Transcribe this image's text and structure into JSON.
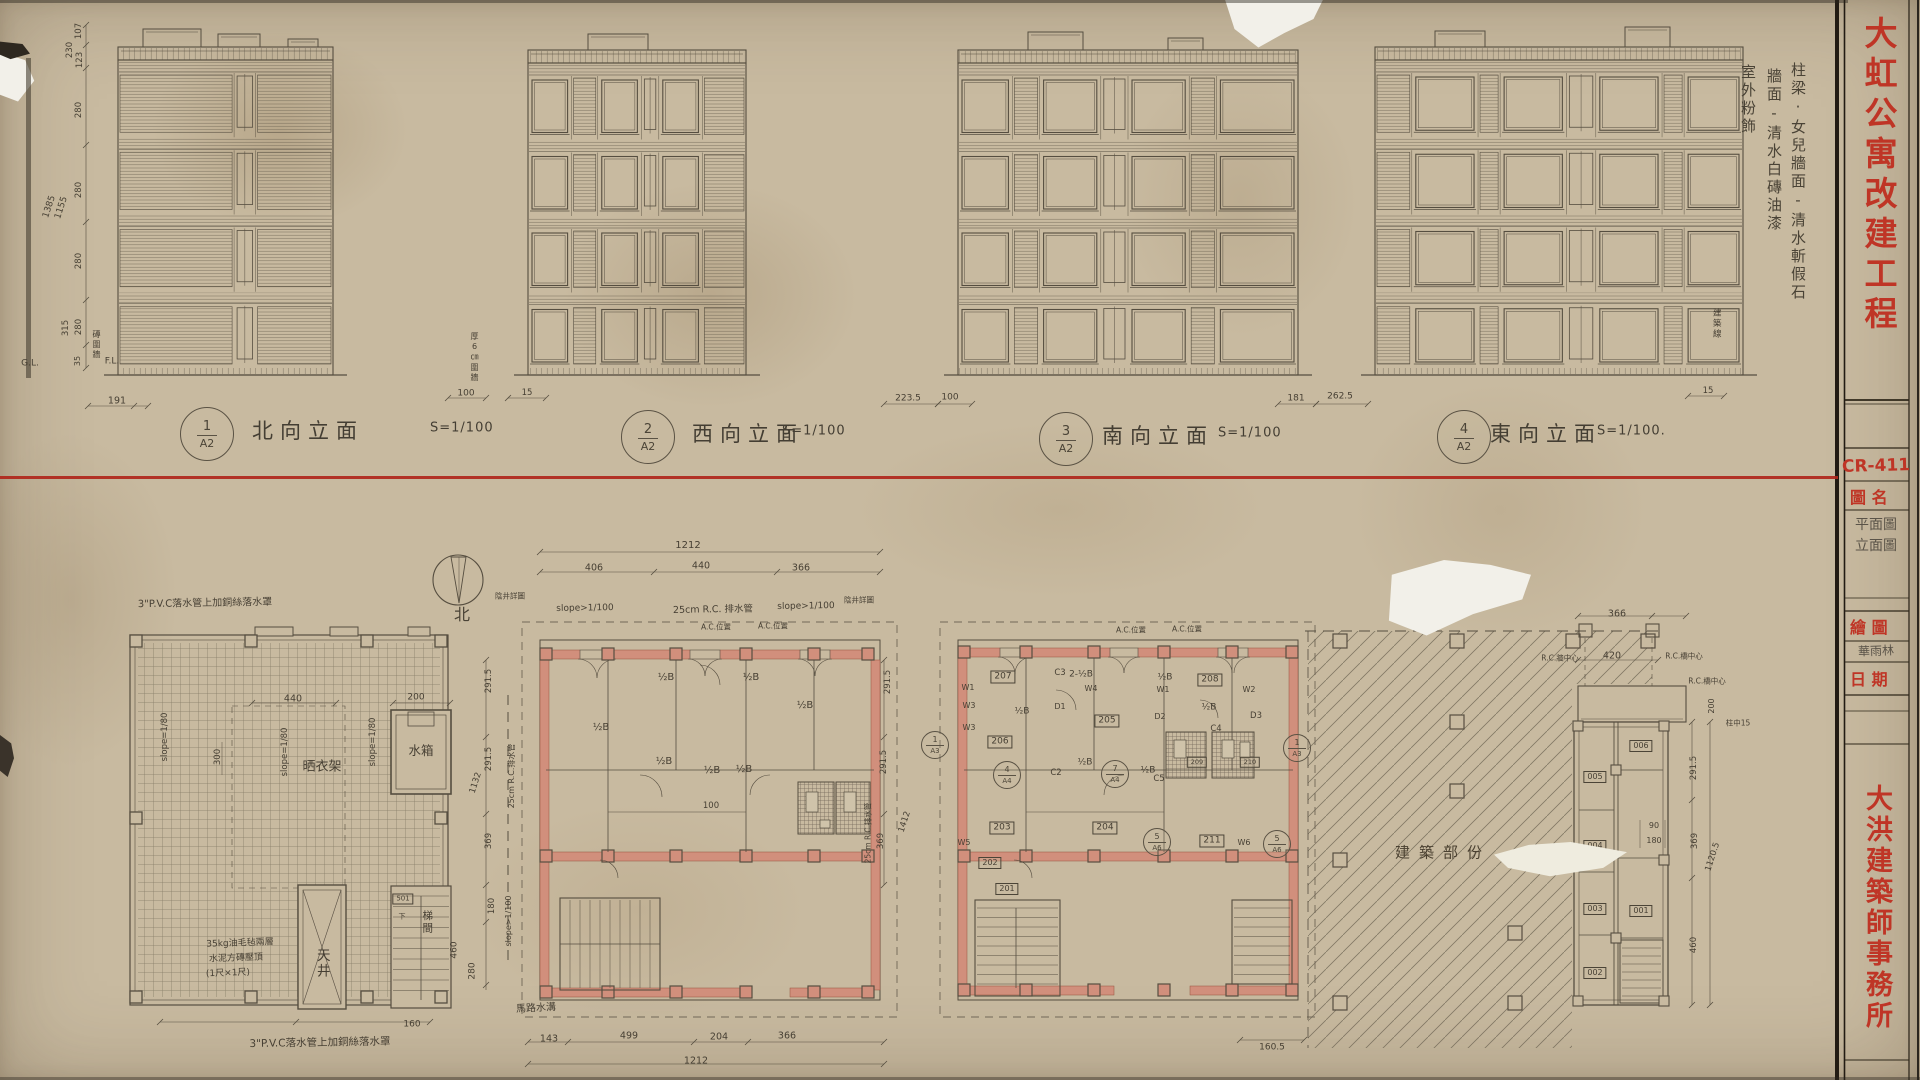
{
  "sheet": {
    "project_title": "大虹公寓改建工程",
    "drawing_code": "CR-411",
    "field_drawing_name": "圖 名",
    "drawing_names": [
      "平面圖",
      "立面圖"
    ],
    "field_draftsman": "繪 圖",
    "draftsman": "華雨林",
    "field_date": "日 期",
    "firm_name": "大洪建築師事務所"
  },
  "finish_notes": [
    "柱梁·女兒牆面-清水斬假石",
    "牆面-清水白磚油漆",
    "室外粉飾"
  ],
  "compass_label": "北",
  "elevations": [
    {
      "num": "1",
      "sheet": "A2",
      "name": "北向立面",
      "scale": "S=1/100"
    },
    {
      "num": "2",
      "sheet": "A2",
      "name": "西向立面",
      "scale": "S=1/100"
    },
    {
      "num": "3",
      "sheet": "A2",
      "name": "南向立面",
      "scale": "S=1/100"
    },
    {
      "num": "4",
      "sheet": "A2",
      "name": "東向立面",
      "scale": "S=1/100."
    }
  ],
  "ref_badges": [
    {
      "n": "1",
      "s": "A3",
      "x": 935,
      "y": 745
    },
    {
      "n": "1",
      "s": "A3",
      "x": 1297,
      "y": 748
    },
    {
      "n": "4",
      "s": "A4",
      "x": 1007,
      "y": 775
    },
    {
      "n": "7",
      "s": "A4",
      "x": 1115,
      "y": 774
    },
    {
      "n": "5",
      "s": "A6",
      "x": 1157,
      "y": 842
    },
    {
      "n": "5",
      "s": "A6",
      "x": 1277,
      "y": 844
    }
  ],
  "annotations": [
    [
      "107",
      79,
      31,
      -90,
      8.5
    ],
    [
      "230",
      70,
      50,
      -90,
      8.5
    ],
    [
      "123",
      80,
      60,
      -90,
      8.5
    ],
    [
      "280",
      79,
      110,
      -90,
      8.5
    ],
    [
      "280",
      79,
      190,
      -90,
      8.5
    ],
    [
      "1385",
      50,
      207,
      -72,
      9
    ],
    [
      "1155",
      62,
      208,
      -72,
      9
    ],
    [
      "280",
      79,
      261,
      -90,
      8.5
    ],
    [
      "315",
      66,
      328,
      -90,
      8.5
    ],
    [
      "280",
      79,
      327,
      -90,
      8.5
    ],
    [
      "35",
      78,
      361,
      -90,
      8
    ],
    [
      "G.L.",
      30,
      364,
      0,
      9
    ],
    [
      "F.L.",
      112,
      362,
      0,
      9
    ],
    [
      "191",
      117,
      401,
      0,
      9.5
    ],
    [
      "100",
      466,
      394,
      0,
      9
    ],
    [
      "15",
      527,
      393,
      0,
      8.5
    ],
    [
      "223.5",
      908,
      399,
      0,
      9
    ],
    [
      "100",
      950,
      398,
      0,
      9
    ],
    [
      "181",
      1296,
      399,
      0,
      9
    ],
    [
      "262.5",
      1340,
      397,
      0,
      9
    ],
    [
      "15",
      1708,
      391,
      0,
      8.5
    ],
    [
      "磚圍牆",
      96,
      330,
      0,
      8,
      "v"
    ],
    [
      "厚6㎝圍牆",
      474,
      332,
      0,
      8,
      "v"
    ],
    [
      "建築線",
      1716,
      308,
      0,
      8.5,
      "v"
    ],
    [
      "3\"P.V.C落水管上加銅絲落水罩",
      205,
      604,
      -1,
      10
    ],
    [
      "slope=1/80",
      165,
      737,
      -90,
      8.5
    ],
    [
      "slope=1/80",
      285,
      752,
      -90,
      8.5
    ],
    [
      "slope=1/80",
      373,
      742,
      -90,
      8.5
    ],
    [
      "440",
      293,
      699,
      0,
      9.5
    ],
    [
      "200",
      416,
      698,
      0,
      9
    ],
    [
      "300",
      218,
      757,
      -90,
      8.5
    ],
    [
      "晒衣架",
      322,
      767,
      0,
      13
    ],
    [
      "水箱",
      421,
      751,
      0,
      12.5
    ],
    [
      "35kg油毛毡兩層",
      240,
      944,
      -2,
      9
    ],
    [
      "水泥方磚壓頂",
      236,
      959,
      -2,
      9
    ],
    [
      "(1尺×1尺)",
      228,
      974,
      -2,
      9
    ],
    [
      "天井",
      321,
      948,
      0,
      13.5,
      "v"
    ],
    [
      "梯間",
      427,
      910,
      0,
      10.5,
      "v"
    ],
    [
      "501",
      403,
      899,
      0,
      7,
      "b"
    ],
    [
      "下",
      402,
      917,
      0,
      7
    ],
    [
      "460",
      455,
      950,
      -90,
      9
    ],
    [
      "280",
      473,
      971,
      -90,
      9
    ],
    [
      "160",
      412,
      1025,
      0,
      9
    ],
    [
      "3\"P.V.C落水管上加銅絲落水罩",
      320,
      1043,
      -1,
      10.5
    ],
    [
      "291.5",
      489,
      681,
      -90,
      8.5
    ],
    [
      "291.5",
      489,
      759,
      -90,
      8.5
    ],
    [
      "1132",
      476,
      783,
      -72,
      8.5
    ],
    [
      "369",
      489,
      841,
      -90,
      8.5
    ],
    [
      "180",
      492,
      906,
      -90,
      8.5
    ],
    [
      "25cm R.C.排水管",
      512,
      776,
      -90,
      8
    ],
    [
      "slope>1/100",
      509,
      921,
      -90,
      8
    ],
    [
      "1212",
      688,
      546,
      0,
      10
    ],
    [
      "406",
      594,
      568,
      0,
      9.5
    ],
    [
      "440",
      701,
      566,
      0,
      9.5
    ],
    [
      "366",
      801,
      568,
      0,
      9.5
    ],
    [
      "slope>1/100",
      585,
      609,
      -1,
      9
    ],
    [
      "25cm R.C. 排水管",
      713,
      610,
      -1,
      9.5
    ],
    [
      "slope>1/100",
      806,
      607,
      -1,
      9
    ],
    [
      "陰井詳圖",
      510,
      596,
      0,
      7.5
    ],
    [
      "陰井詳圖",
      859,
      600,
      0,
      7.5
    ],
    [
      "A.C.位置",
      716,
      627,
      0,
      7.5
    ],
    [
      "A.C.位置",
      773,
      626,
      0,
      7.5
    ],
    [
      "½B",
      666,
      678,
      0,
      10
    ],
    [
      "½B",
      751,
      678,
      0,
      10
    ],
    [
      "½B",
      601,
      728,
      0,
      10
    ],
    [
      "½B",
      664,
      762,
      0,
      10
    ],
    [
      "½B",
      805,
      706,
      0,
      10
    ],
    [
      "½B",
      712,
      771,
      0,
      10
    ],
    [
      "½B",
      744,
      770,
      0,
      10
    ],
    [
      "100",
      711,
      806,
      0,
      8.5
    ],
    [
      "143",
      549,
      1039,
      0,
      9.5
    ],
    [
      "499",
      629,
      1036,
      0,
      9.5
    ],
    [
      "204",
      719,
      1037,
      0,
      9.5
    ],
    [
      "366",
      787,
      1036,
      0,
      9.5
    ],
    [
      "1212",
      696,
      1061,
      0,
      9.5
    ],
    [
      "馬路水溝",
      536,
      1009,
      -3,
      10
    ],
    [
      "291.5",
      888,
      682,
      -90,
      8.5
    ],
    [
      "291.5",
      884,
      762,
      -90,
      8.5
    ],
    [
      "369",
      881,
      841,
      -90,
      8.5
    ],
    [
      "1412",
      905,
      822,
      -72,
      8.5
    ],
    [
      "25cm R.C.排水管",
      868,
      833,
      -90,
      7.5
    ],
    [
      "207",
      1003,
      677,
      0,
      9,
      "b"
    ],
    [
      "208",
      1210,
      680,
      0,
      9,
      "b"
    ],
    [
      "206",
      1000,
      742,
      0,
      9,
      "b"
    ],
    [
      "205",
      1107,
      721,
      0,
      9,
      "b"
    ],
    [
      "203",
      1002,
      828,
      0,
      9,
      "b"
    ],
    [
      "204",
      1105,
      828,
      0,
      9,
      "b"
    ],
    [
      "211",
      1212,
      841,
      0,
      9,
      "b"
    ],
    [
      "209",
      1197,
      762,
      0,
      6.5,
      "b"
    ],
    [
      "210",
      1250,
      762,
      0,
      6.5,
      "b"
    ],
    [
      "202",
      990,
      863,
      0,
      8,
      "b"
    ],
    [
      "201",
      1007,
      889,
      0,
      8,
      "b"
    ],
    [
      "W1",
      968,
      688,
      0,
      8
    ],
    [
      "W4",
      1091,
      689,
      0,
      8
    ],
    [
      "W1",
      1163,
      690,
      0,
      8
    ],
    [
      "W2",
      1249,
      690,
      0,
      8
    ],
    [
      "W3",
      969,
      706,
      0,
      8
    ],
    [
      "W3",
      969,
      728,
      0,
      8
    ],
    [
      "W5",
      964,
      843,
      0,
      8
    ],
    [
      "W6",
      1244,
      843,
      0,
      8
    ],
    [
      "D1",
      1060,
      707,
      0,
      8
    ],
    [
      "D2",
      1160,
      717,
      0,
      8
    ],
    [
      "D3",
      1256,
      716,
      0,
      8.5
    ],
    [
      "C3",
      1060,
      673,
      0,
      8.5
    ],
    [
      "C4",
      1216,
      729,
      0,
      8.5
    ],
    [
      "C5",
      1159,
      779,
      0,
      8.5
    ],
    [
      "C2",
      1056,
      773,
      0,
      8.5
    ],
    [
      "2-½B",
      1081,
      675,
      0,
      9
    ],
    [
      "½B",
      1165,
      678,
      0,
      9
    ],
    [
      "½B",
      1022,
      712,
      0,
      9
    ],
    [
      "½B",
      1209,
      708,
      0,
      9
    ],
    [
      "½B",
      1085,
      763,
      0,
      9
    ],
    [
      "½B",
      1148,
      771,
      0,
      9
    ],
    [
      "A.C.位置",
      1131,
      630,
      0,
      7.5
    ],
    [
      "A.C.位置",
      1187,
      629,
      0,
      7.5
    ],
    [
      "160.5",
      1272,
      1048,
      0,
      9
    ],
    [
      "建築部份",
      1443,
      853,
      0,
      15,
      "ls"
    ],
    [
      "366",
      1617,
      614,
      0,
      9.5
    ],
    [
      "R.C.牆中心",
      1560,
      658,
      0,
      7.5
    ],
    [
      "420",
      1612,
      656,
      0,
      9.5
    ],
    [
      "R.C.橋中心",
      1684,
      656,
      0,
      7.5
    ],
    [
      "R.C.橋中心",
      1707,
      681,
      0,
      7.5
    ],
    [
      "柱中15",
      1738,
      723,
      0,
      7.5
    ],
    [
      "200",
      1712,
      706,
      -90,
      8
    ],
    [
      "90",
      1654,
      826,
      0,
      8
    ],
    [
      "180",
      1654,
      841,
      0,
      8
    ],
    [
      "291.5",
      1694,
      768,
      -90,
      8.5
    ],
    [
      "369",
      1695,
      841,
      -90,
      8.5
    ],
    [
      "460",
      1694,
      945,
      -90,
      8.5
    ],
    [
      "1120.5",
      1713,
      857,
      -72,
      8.5
    ],
    [
      "006",
      1641,
      746,
      0,
      8,
      "b"
    ],
    [
      "005",
      1595,
      777,
      0,
      8,
      "b"
    ],
    [
      "004",
      1595,
      846,
      0,
      8,
      "b"
    ],
    [
      "003",
      1595,
      909,
      0,
      8,
      "b"
    ],
    [
      "001",
      1641,
      911,
      0,
      8,
      "b"
    ],
    [
      "002",
      1595,
      973,
      0,
      8,
      "b"
    ]
  ]
}
